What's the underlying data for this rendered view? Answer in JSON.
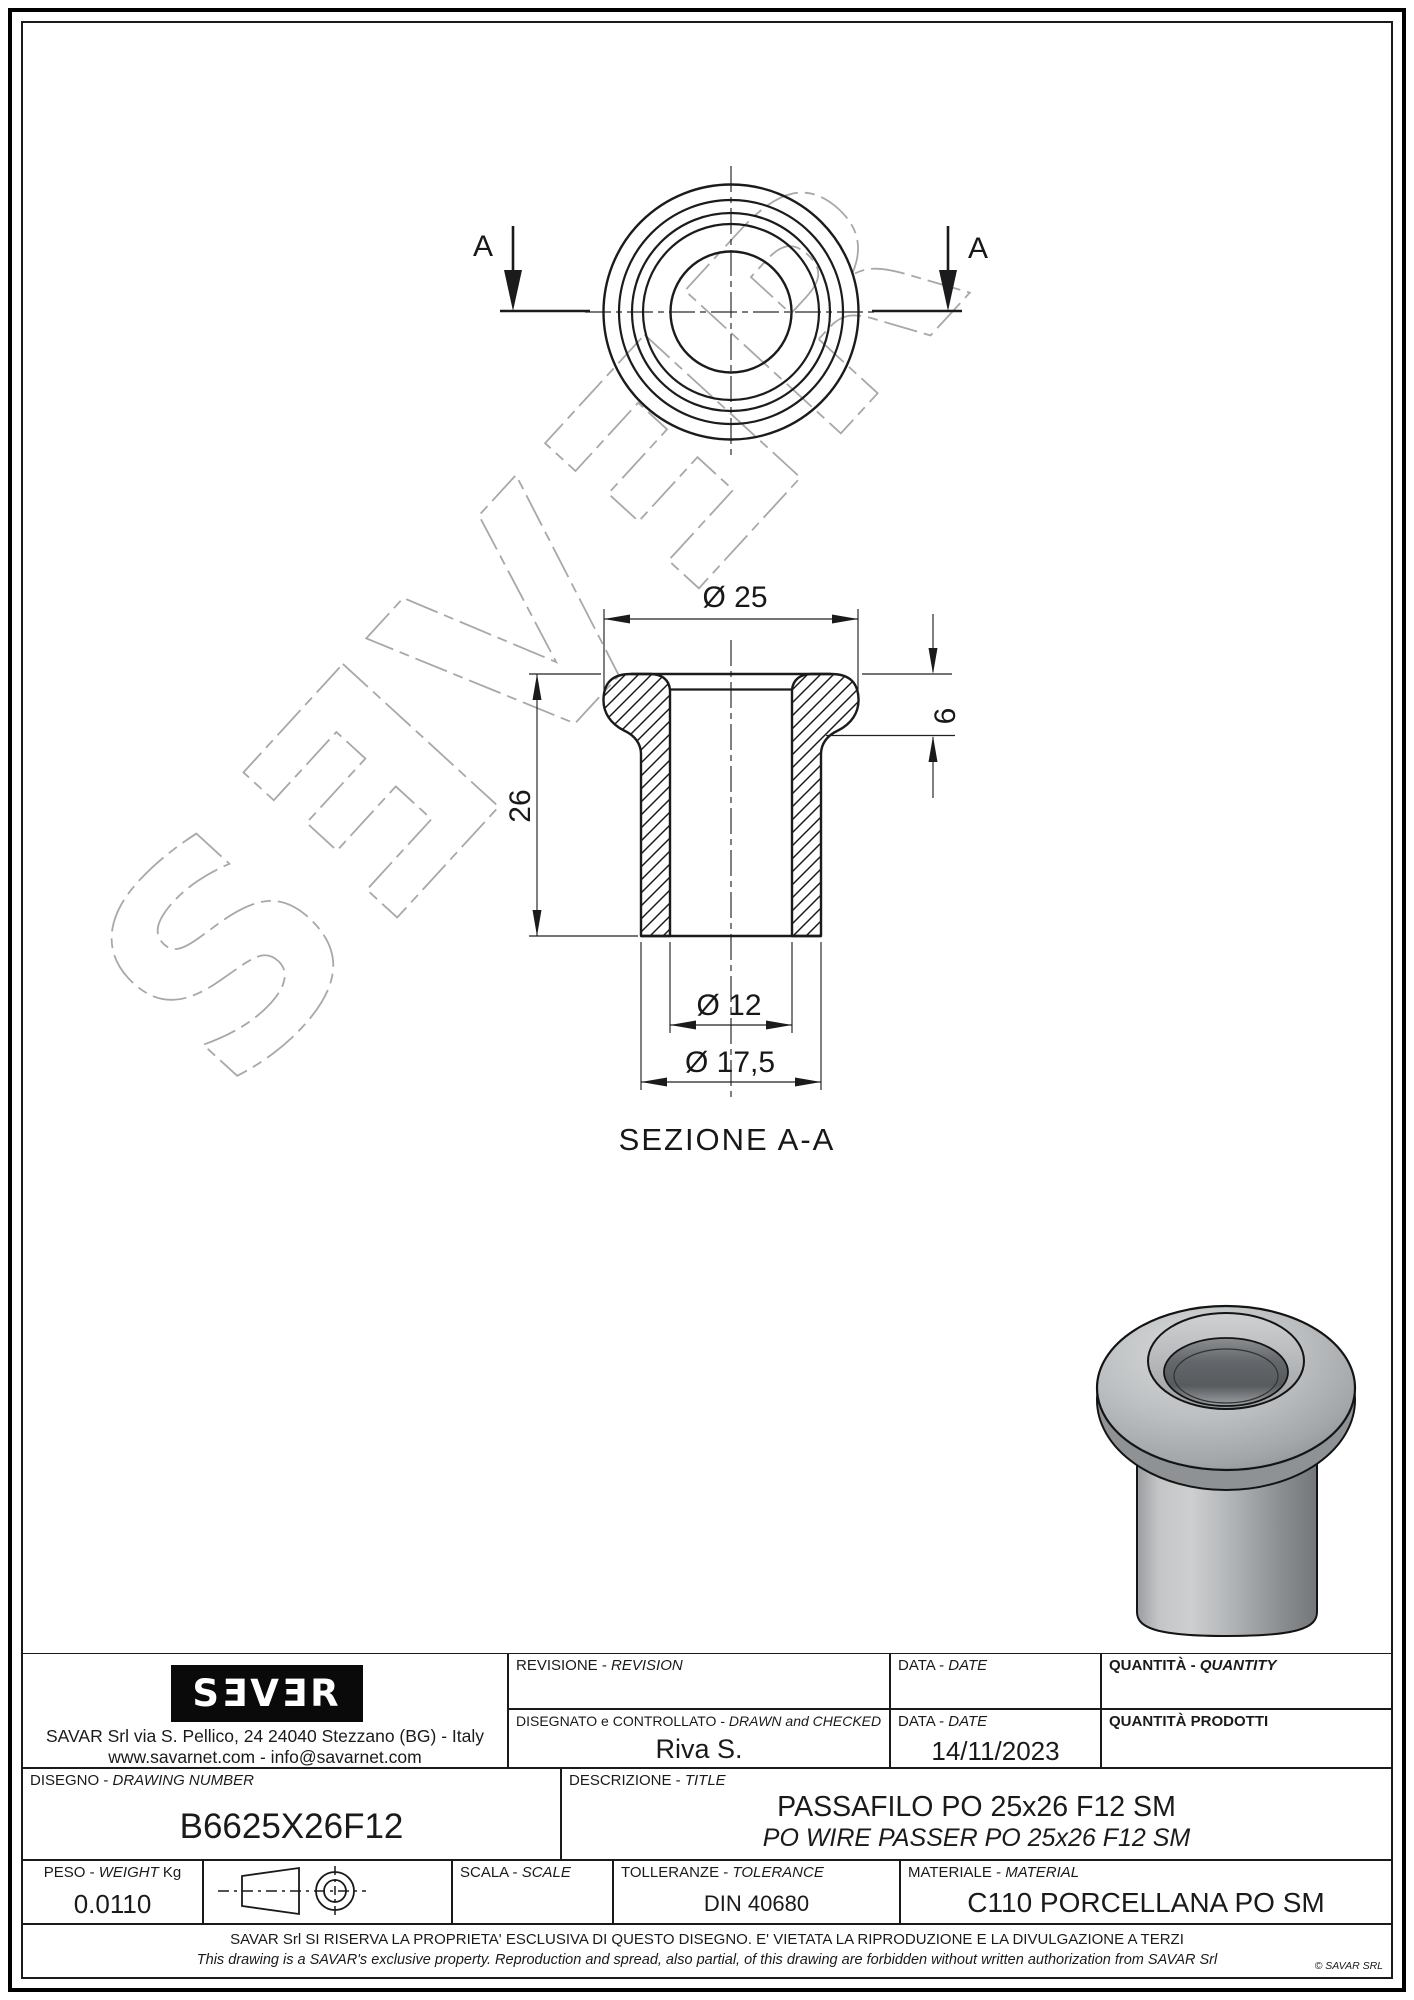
{
  "watermark": {
    "text": "SƎVƎR"
  },
  "top_view": {
    "section_arrow_left_label": "A",
    "section_arrow_right_label": "A"
  },
  "section_view": {
    "caption": "SEZIONE A-A",
    "dim_flange_diameter": "Ø 25",
    "dim_flange_height": "6",
    "dim_total_height": "26",
    "dim_bore_diameter": "Ø 12",
    "dim_body_diameter": "Ø 17,5"
  },
  "title_block": {
    "logo_text": "SƎVƎR",
    "company_address": "SAVAR Srl via S. Pellico, 24  24040 Stezzano (BG) - Italy",
    "company_contacts": "www.savarnet.com  -  info@savarnet.com",
    "revision": {
      "label_it": "REVISIONE - ",
      "label_en": "REVISION",
      "value": ""
    },
    "date_top": {
      "label_it": "DATA - ",
      "label_en": "DATE",
      "value": ""
    },
    "quantity": {
      "label_it": "QUANTITÀ - ",
      "label_en": "QUANTITY",
      "value": ""
    },
    "drawn": {
      "label_it": "DISEGNATO e CONTROLLATO - ",
      "label_en": "DRAWN and CHECKED",
      "value": "Riva S."
    },
    "date_bottom": {
      "label_it": "DATA - ",
      "label_en": "DATE",
      "value": "14/11/2023"
    },
    "quantity_produced": {
      "label": "QUANTITÀ  PRODOTTI",
      "value": ""
    },
    "drawing_number": {
      "label_it": "DISEGNO - ",
      "label_en": "DRAWING NUMBER",
      "value": "B6625X26F12"
    },
    "description": {
      "label_it": "DESCRIZIONE - ",
      "label_en": "TITLE",
      "value_it": "PASSAFILO PO 25x26 F12 SM",
      "value_en": "PO WIRE PASSER PO 25x26 F12 SM"
    },
    "weight": {
      "label_it": "PESO - ",
      "label_en": "WEIGHT",
      "label_unit": " Kg",
      "value": "0.0110"
    },
    "scale": {
      "label_it": "SCALA - ",
      "label_en": "SCALE",
      "value": ""
    },
    "tolerance": {
      "label_it": "TOLLERANZE - ",
      "label_en": "TOLERANCE",
      "value": "DIN 40680"
    },
    "material": {
      "label_it": "MATERIALE - ",
      "label_en": "MATERIAL",
      "value": "C110 PORCELLANA PO SM"
    },
    "disclaimer_it": "SAVAR Srl SI RISERVA LA PROPRIETA' ESCLUSIVA DI QUESTO DISEGNO. E' VIETATA LA RIPRODUZIONE E LA DIVULGAZIONE A TERZI",
    "disclaimer_en": "This drawing is a SAVAR's exclusive property. Reproduction and spread, also partial, of this drawing are forbidden without written authorization from SAVAR Srl",
    "copyright": "© SAVAR SRL"
  },
  "colors": {
    "line": "#1b1b1d",
    "watermark_gray": "#a5a9ac",
    "render_gray": "#a7aaac"
  }
}
